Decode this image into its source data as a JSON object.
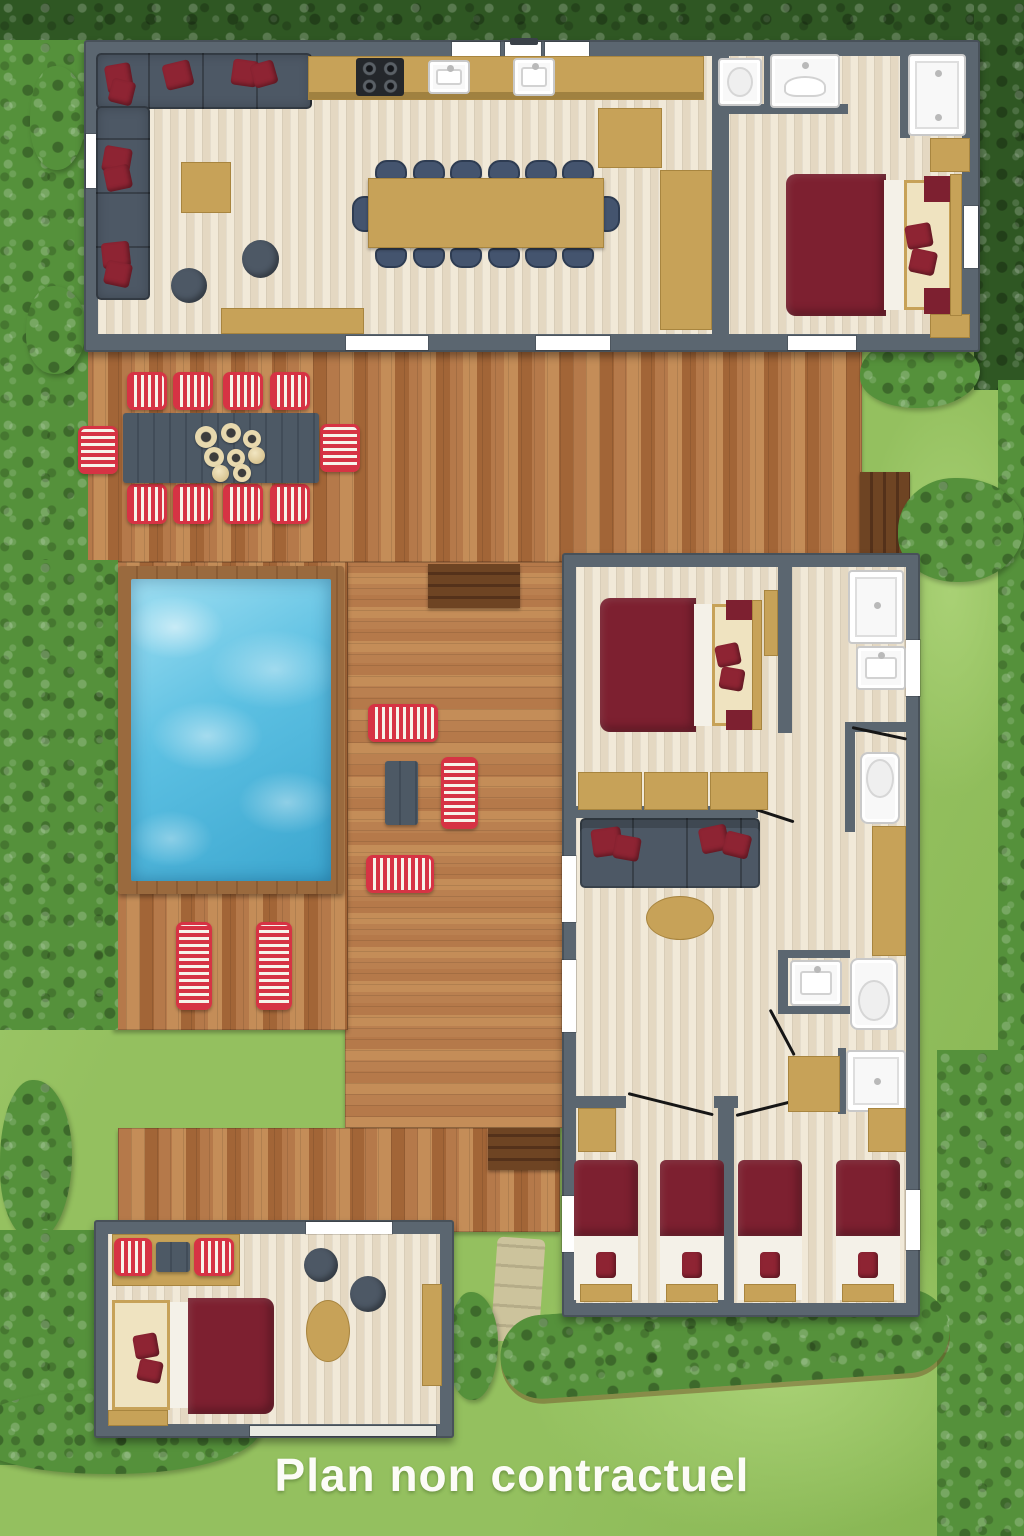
{
  "caption": "Plan non contractuel",
  "palette": {
    "lawn": "#94c05f",
    "lawn_light": "#a9d175",
    "lawn_dark": "#85b451",
    "hedge": "#55913b",
    "hedge_dark": "#2f5723",
    "wall": "#5b6670",
    "floor_a": "#f1e9d8",
    "floor_b": "#e4d8c2",
    "wood_a": "#b5794a",
    "wood_b": "#a26537",
    "wood_c": "#c48d58",
    "wood_d": "#ba8050",
    "steps": "#6e4423",
    "steps_dark": "#54311a",
    "pool_frame": "#9a6a3e",
    "water_light": "#9fdff2",
    "water": "#5cc0e2",
    "water_deep": "#3ba6cf",
    "tan": "#c7a258",
    "tan_dark": "#a8853f",
    "sofa": "#4d5865",
    "navy": "#44546e",
    "burgundy": "#7d2030",
    "pillow_red": "#8e2433",
    "stripe_red": "#d63344",
    "stripe_white": "#f7f3ea",
    "table_gray": "#4d5965",
    "fixture": "#f8f8f8",
    "fixture_edge": "#c9c9c9",
    "path": "#cfc39f",
    "caption_color": "#fcfcf7"
  },
  "inventory": {
    "areas": [
      "garden",
      "hedge-border",
      "pool",
      "sun-deck",
      "outdoor-dining-deck",
      "main-lodge",
      "guest-lodge",
      "garden-suite",
      "stone-path"
    ],
    "main_lodge": {
      "rooms": [
        "living-room",
        "kitchen",
        "dining-area",
        "wc",
        "shower-room",
        "double-bedroom"
      ],
      "indoor_dining_seats": 14,
      "double_beds": 1
    },
    "guest_lodge": {
      "rooms": [
        "double-bedroom",
        "shower-room",
        "lounge",
        "bathroom",
        "kids-room-left",
        "kids-room-right"
      ],
      "double_beds": 1,
      "single_beds": 4
    },
    "garden_suite": {
      "rooms": [
        "studio-bedroom"
      ],
      "double_beds": 1
    },
    "outdoor": {
      "outdoor_dining_seats": 10,
      "sun_loungers": 2,
      "lounge_benches": 3,
      "pools": 1
    }
  }
}
